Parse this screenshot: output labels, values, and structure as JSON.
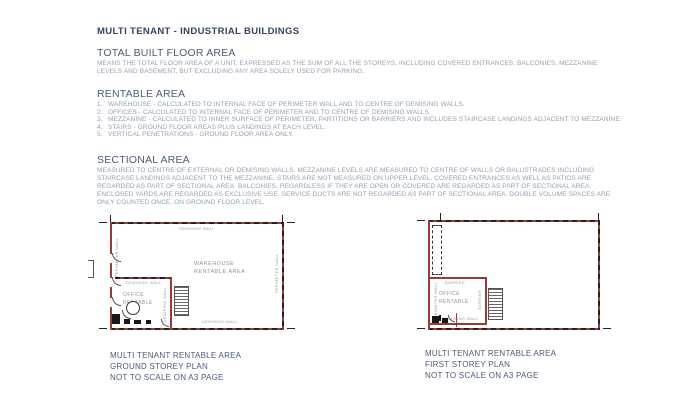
{
  "page": {
    "title": "MULTI TENANT - INDUSTRIAL BUILDINGS"
  },
  "sections": {
    "total_built": {
      "heading": "TOTAL BUILT FLOOR AREA",
      "body": "MEANS THE TOTAL FLOOR AREA OF A UNIT, EXPRESSED AS THE SUM OF ALL THE STOREYS, INCLUDING COVERED ENTRANCES, BALCONIES, MEZZANINE LEVELS AND BASEMENT, BUT EXCLUDING ANY AREA SOLELY USED FOR PARKING."
    },
    "rentable": {
      "heading": "RENTABLE AREA",
      "items": [
        {
          "num": "1.",
          "text": "WAREHOUSE - CALCULATED TO INTERNAL FACE OF PERIMETER WALL AND TO CENTRE OF DEMISING WALLS."
        },
        {
          "num": "2.",
          "text": "OFFICES - CALCULATED TO INTERNAL FACE OF PERIMETER AND TO CENTRE OF DEMISING WALLS."
        },
        {
          "num": "3.",
          "text": "MEZZANINE - CALCULATED TO INNER SURFACE OF PERIMETER, PARTITIONS OR BARRIERS AND INCLUDES STAIRCASE LANDINGS ADJACENT TO MEZZANINE."
        },
        {
          "num": "4.",
          "text": "STAIRS - GROUND FLOOR AREAS PLUS LANDINGS AT EACH LEVEL."
        },
        {
          "num": "5.",
          "text": "VERTICAL PENETRATIONS - GROUND FLOOR AREA ONLY."
        }
      ]
    },
    "sectional": {
      "heading": "SECTIONAL AREA",
      "body": "MEASURED TO CENTRE OF EXTERNAL OR DEMISING WALLS. MEZZANINE LEVELS ARE MEASURED TO CENTRE OF WALLS OR BALUSTRADES INCLUDING STAIRCASE LANDINGS ADJACENT TO THE MEZZANINE. STAIRS ARE NOT MEASURED ON UPPER LEVEL. COVERED ENTRANCES AS WELL AS PATIOS ARE REGARDED AS PART OF SECTIONAL AREA. BALCONIES, REGARDLESS IF THEY ARE OPEN OR COVERED ARE REGARDED AS PART OF SECTIONAL AREA. ENCLOSED YARDS ARE REGARDED AS EXCLUSIVE USE. SERVICE DUCTS ARE NOT REGARDED AS PART OF SECTIONAL AREA. DOUBLE VOLUME SPACES ARE ONLY COUNTED ONCE, ON GROUND FLOOR LEVEL."
    }
  },
  "plans": {
    "ground": {
      "demising_wall_top": "DEMISING WALL",
      "demising_wall_bottom": "DEMISING WALL",
      "perimeter_wall_left": "PERIMETER WALL",
      "perimeter_wall_right": "PERIMETER WALL",
      "office_demising_top": "DEMISING WALL",
      "office_demising_right": "DEMISING WALL",
      "warehouse_area": "WAREHOUSE\nRENTABLE AREA",
      "office_area": "OFFICE\nRENTABLE",
      "caption": "MULTI TENANT RENTABLE AREA\nGROUND STOREY PLAN\nNOT TO SCALE ON A3 PAGE"
    },
    "first": {
      "barrier_top": "BARRIER",
      "barrier_right": "BARRIER",
      "perimeter_wall_left": "PERIMETER WALL",
      "demising_wall_bottom": "DEMISING WALL",
      "office_area": "OFFICE\nRENTABLE",
      "caption": "MULTI TENANT RENTABLE AREA\nFIRST STOREY PLAN\nNOT TO SCALE ON A3 PAGE"
    }
  },
  "colors": {
    "title_text": "#36455d",
    "section_heading_text": "#4c5d78",
    "body_text": "#94a1b1",
    "caption_text": "#4a5b76",
    "wall_red": "#9b3a36",
    "wall_dash_black": "#222222",
    "plan_label_gray": "#9aa0a6"
  }
}
